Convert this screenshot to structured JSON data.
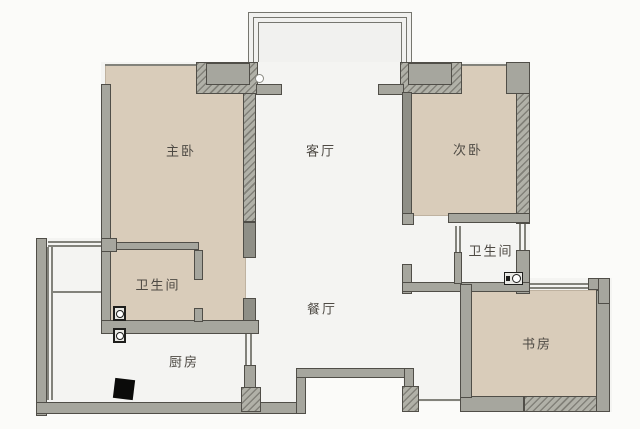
{
  "floorplan": {
    "type": "apartment-floor-plan",
    "rooms": {
      "master_bedroom": {
        "label": "主卧"
      },
      "living_room": {
        "label": "客厅"
      },
      "second_bedroom": {
        "label": "次卧"
      },
      "dining_room": {
        "label": "餐厅"
      },
      "kitchen": {
        "label": "厨房"
      },
      "study": {
        "label": "书房"
      },
      "master_bathroom": {
        "label": "卫生间"
      },
      "guest_bathroom": {
        "label": "卫生间"
      }
    },
    "colors": {
      "room_fill": "#d9ccba",
      "wall": "#a6a69e",
      "wall_dark": "#8f8f87",
      "open_floor": "#f4f4f2",
      "background": "#fbfbf9",
      "outline": "#504e48"
    },
    "icons": {
      "flue": "kitchen-flue",
      "floor_drain": "floor-drain",
      "toilet": "toilet-fixture",
      "switch": "round-switch"
    }
  }
}
